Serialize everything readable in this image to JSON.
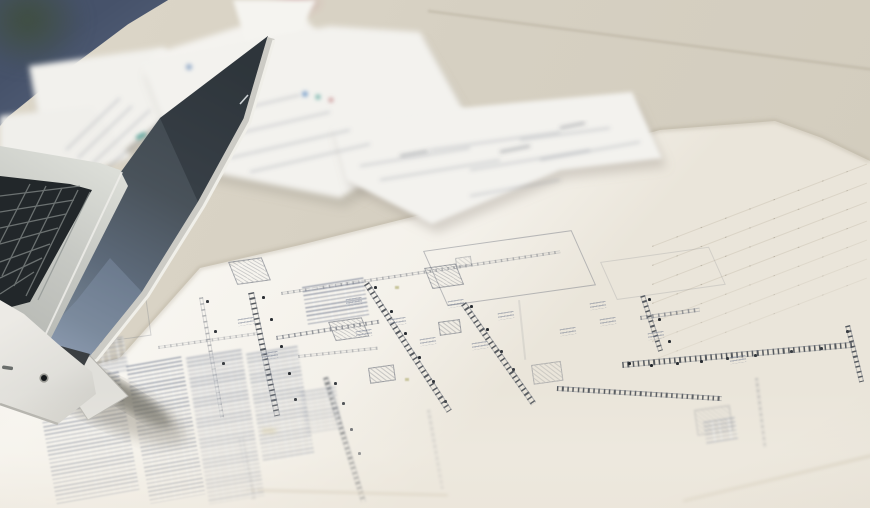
{
  "scene": {
    "subject": "architectural blueprint floor plan spread on a desk, with an open silver laptop at the left and blurred scattered note papers behind it",
    "focus": "sharp on the center of the floor plan; foreground bottom and background top are out of focus",
    "no_legible_text": true
  },
  "colors": {
    "desk": "#d6d0c2",
    "desk-light": "#ddd7c9",
    "corner-blue": "#46526a",
    "corner-green": "#3f4e3e",
    "smudge-pink": "#c4858e",
    "sheet": "#f5f3ed",
    "sheet-bright": "#f8f6f1",
    "sheet-shadow": "#e9e4d8",
    "paper": "#f3f2ee",
    "lid-dark": "#394147",
    "lid-mid": "#4b545c",
    "lid-reflection": "#758597",
    "rim-silver": "#d7d6d1",
    "deck-silver": "#cdcfca",
    "key-black": "#22272a",
    "base-silver": "#e9e8e3",
    "plan-wall": "#41464c",
    "plan-line": "#8a8e96",
    "plan-tan": "#c9bfa9",
    "spec-text": "#6e7890",
    "dim-line": "#a79a82",
    "fleck-blue": "#6290c4",
    "fleck-teal": "#55a49b",
    "fleck-red": "#bf7e80",
    "fleck-olive": "#aaa866"
  },
  "objects": [
    "laptop",
    "blueprint-sheet",
    "note-papers",
    "desk",
    "blue-corner-object",
    "plant-blur",
    "pink-smudge",
    "plan-walls",
    "room-outlines",
    "fixture-boxes",
    "dimension-lines",
    "specification-text-columns"
  ]
}
